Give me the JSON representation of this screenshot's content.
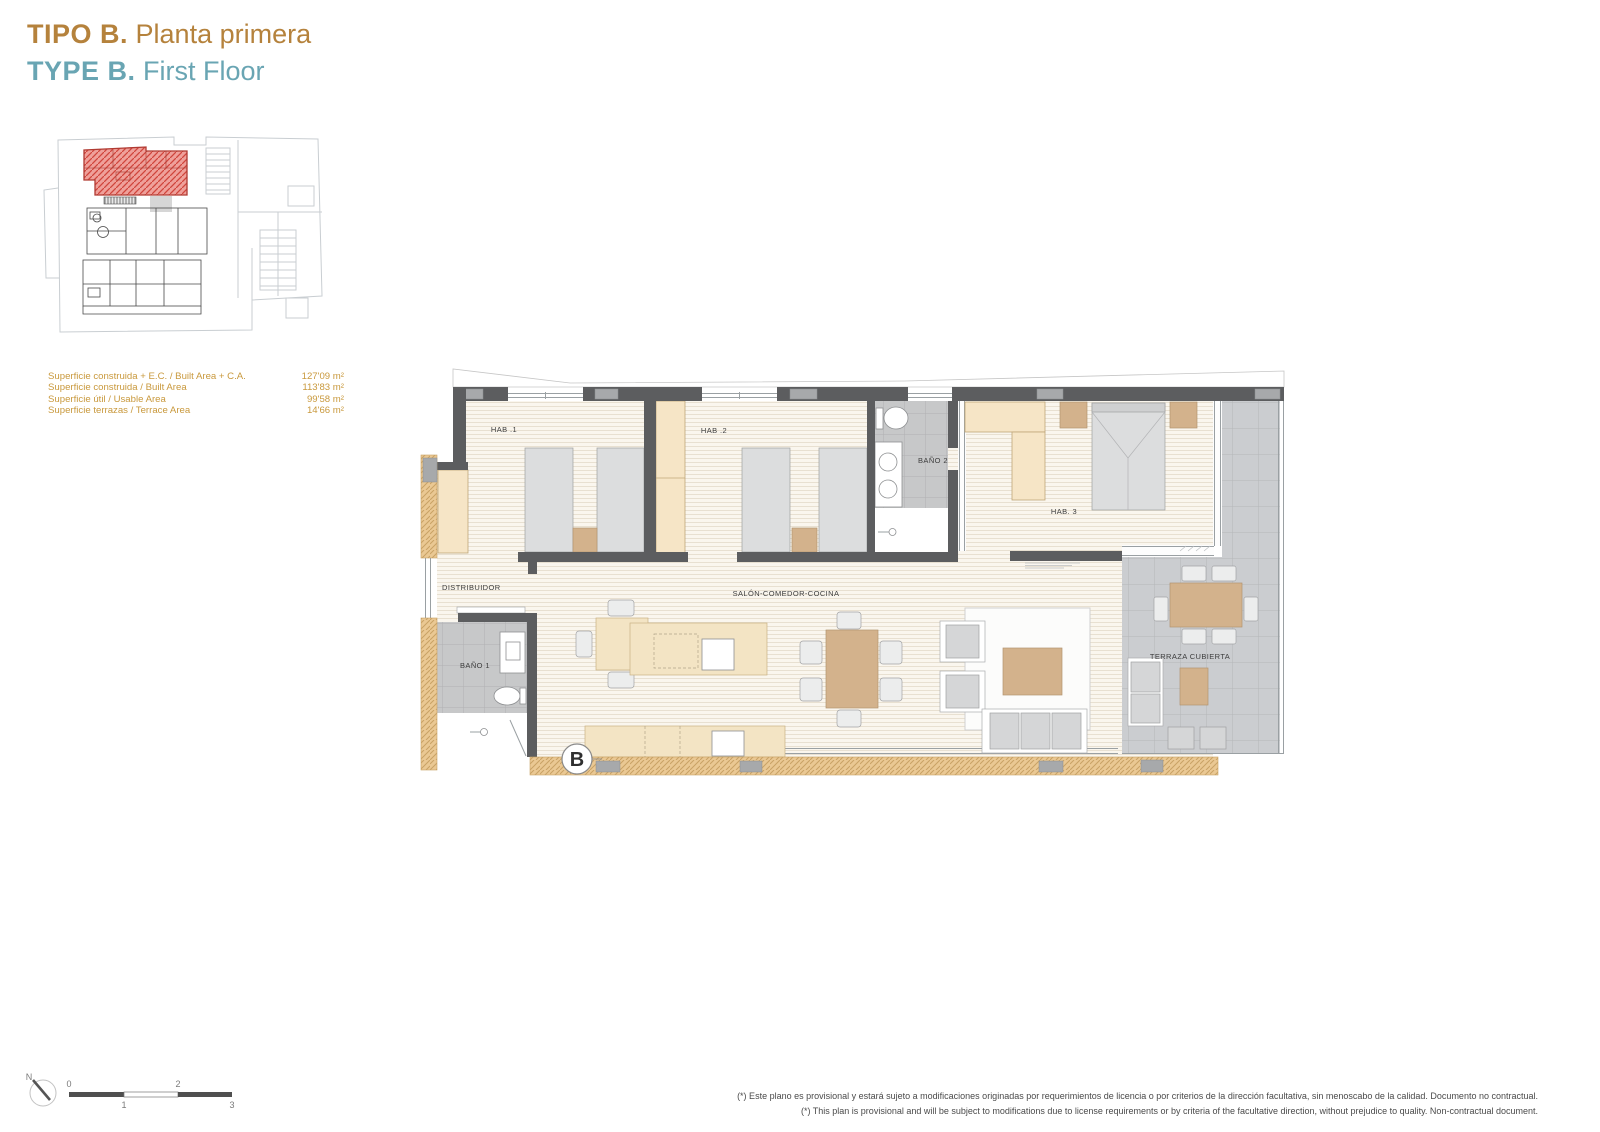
{
  "header": {
    "title_es_bold": "TIPO B.",
    "title_es_rest": "Planta primera",
    "title_en_bold": "TYPE B.",
    "title_en_rest": "First Floor"
  },
  "areas": {
    "rows": [
      {
        "label": "Superficie construida + E.C. / Built Area + C.A.",
        "value": "127'09 m²"
      },
      {
        "label": "Superficie construida / Built Area",
        "value": "113'83 m²"
      },
      {
        "label": "Superficie útil / Usable Area",
        "value": "99'58 m²"
      },
      {
        "label": "Superficie terrazas / Terrace Area",
        "value": "14'66 m²"
      }
    ]
  },
  "plan": {
    "labels": {
      "hab1": "HAB .1",
      "hab2": "HAB .2",
      "bano2": "BAÑO 2",
      "hab3": "HAB. 3",
      "distribuidor": "DISTRIBUIDOR",
      "salon": "SALÓN-COMEDOR-COCINA",
      "bano1": "BAÑO 1",
      "terraza": "TERRAZA CUBIERTA"
    },
    "section_marker": "B"
  },
  "scale_bar": {
    "labels": [
      "0",
      "1",
      "2",
      "3"
    ],
    "north_label": "N"
  },
  "footer": {
    "disclaimer_es": "(*) Este plano es provisional y estará sujeto a modificaciones originadas por requerimientos de licencia o por criterios de la dirección facultativa, sin menoscabo de la calidad. Documento no contractual.",
    "disclaimer_en": "(*) This plan is provisional and will be subject to modifications due to license requirements or by criteria of the facultative direction, without prejudice to quality. Non-contractual document."
  },
  "colors": {
    "title_es": "#b5823c",
    "title_en": "#69a5b3",
    "area_text": "#c9993d",
    "wall": "#5c5d5f",
    "floor_base": "#faf6ee",
    "floor_stripe": "#e8e0d1",
    "tile_base": "#cbcdd0",
    "tile_line": "#b4b7b9",
    "furniture_tan": "#d3b28c",
    "wardrobe_beige": "#f6e5c6",
    "exterior_tan": "#eac893",
    "highlight_red": "#e8534a",
    "label_text": "#3d3d3d",
    "disclaimer_text": "#4a4a4a",
    "keyplan_line": "#c9ced2"
  }
}
